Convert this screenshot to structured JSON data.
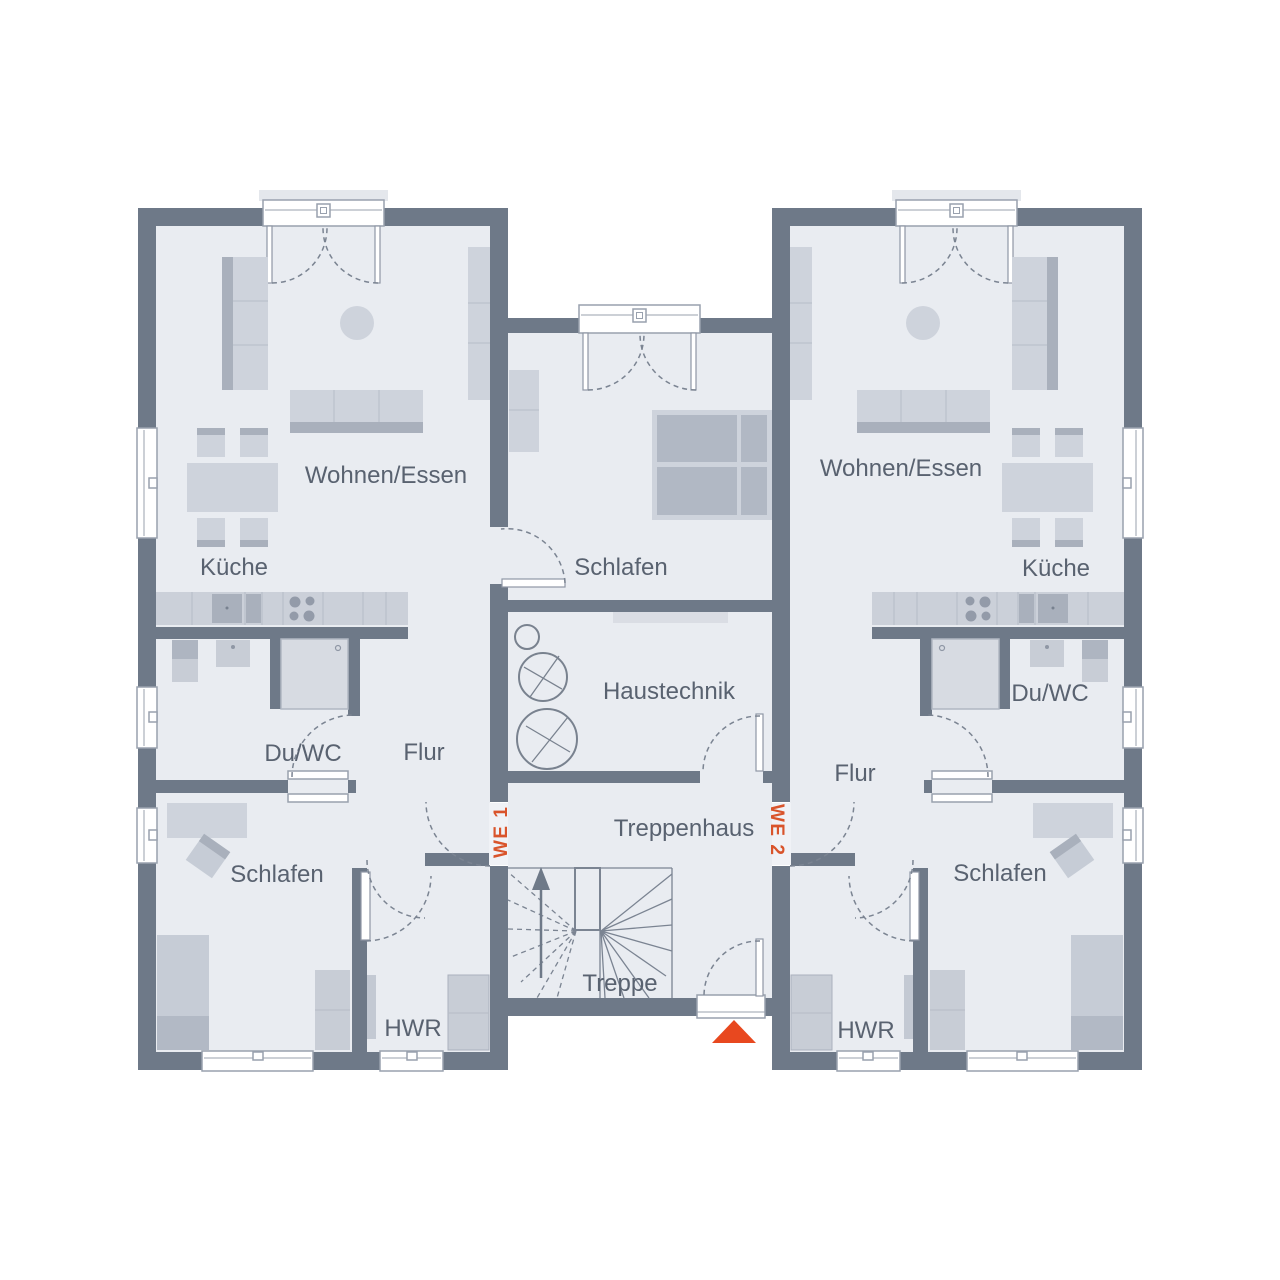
{
  "plan": {
    "unit1": {
      "tag": "WE 1",
      "living": "Wohnen/Essen",
      "kitchen": "Küche",
      "bath": "Du/WC",
      "hall": "Flur",
      "bedroom": "Schlafen",
      "utility": "HWR"
    },
    "unit2": {
      "tag": "WE 2",
      "living": "Wohnen/Essen",
      "kitchen": "Küche",
      "bath": "Du/WC",
      "hall": "Flur",
      "bedroom": "Schlafen",
      "utility": "HWR"
    },
    "shared": {
      "bedroom": "Schlafen",
      "technical": "Haustechnik",
      "stair_hall": "Treppenhaus",
      "stair": "Treppe"
    },
    "colors": {
      "wall": "#6e7988",
      "floor": "#e9ecf1",
      "furniture": "#ced3dc",
      "furniture_dark": "#a9b0bc",
      "window_frame": "#99a1ae",
      "accent": "#e8481f",
      "unit_tag_text": "#d9542b",
      "room_label_text": "#596270"
    }
  }
}
